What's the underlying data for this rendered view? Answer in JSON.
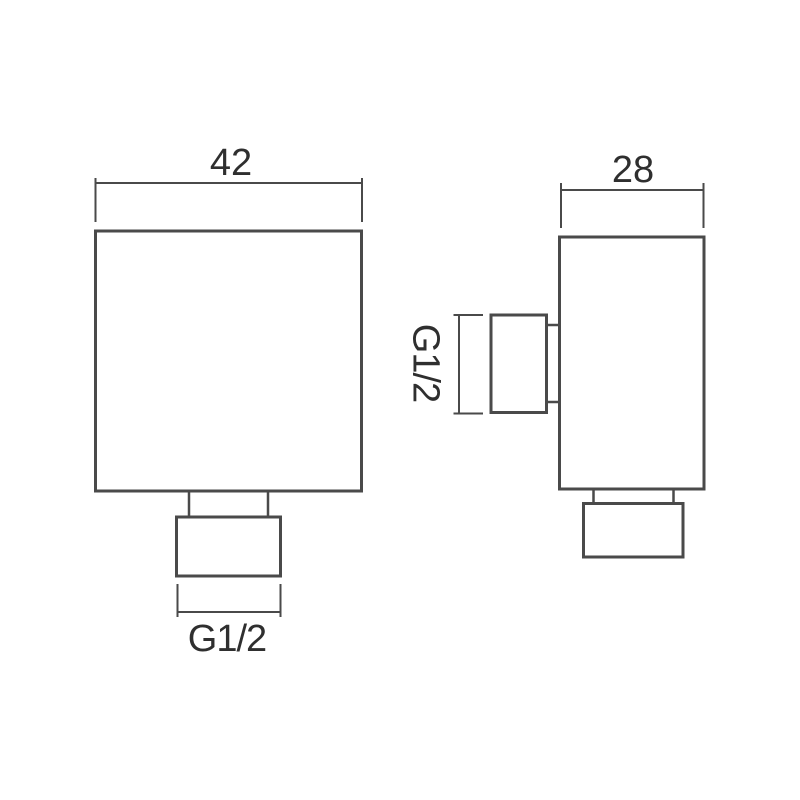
{
  "theme": {
    "background": "#ffffff",
    "line_color": "#4a4a4a",
    "text_color": "#2f2f2f"
  },
  "drawing": {
    "type": "technical-dimension-drawing",
    "views": {
      "front": {
        "name": "front-view",
        "width_dim": {
          "label": "42"
        },
        "bottom_thread_dim": {
          "label": "G1/2"
        }
      },
      "side": {
        "name": "side-view",
        "depth_dim": {
          "label": "28"
        },
        "side_thread_dim": {
          "label": "G1/2"
        }
      }
    }
  }
}
